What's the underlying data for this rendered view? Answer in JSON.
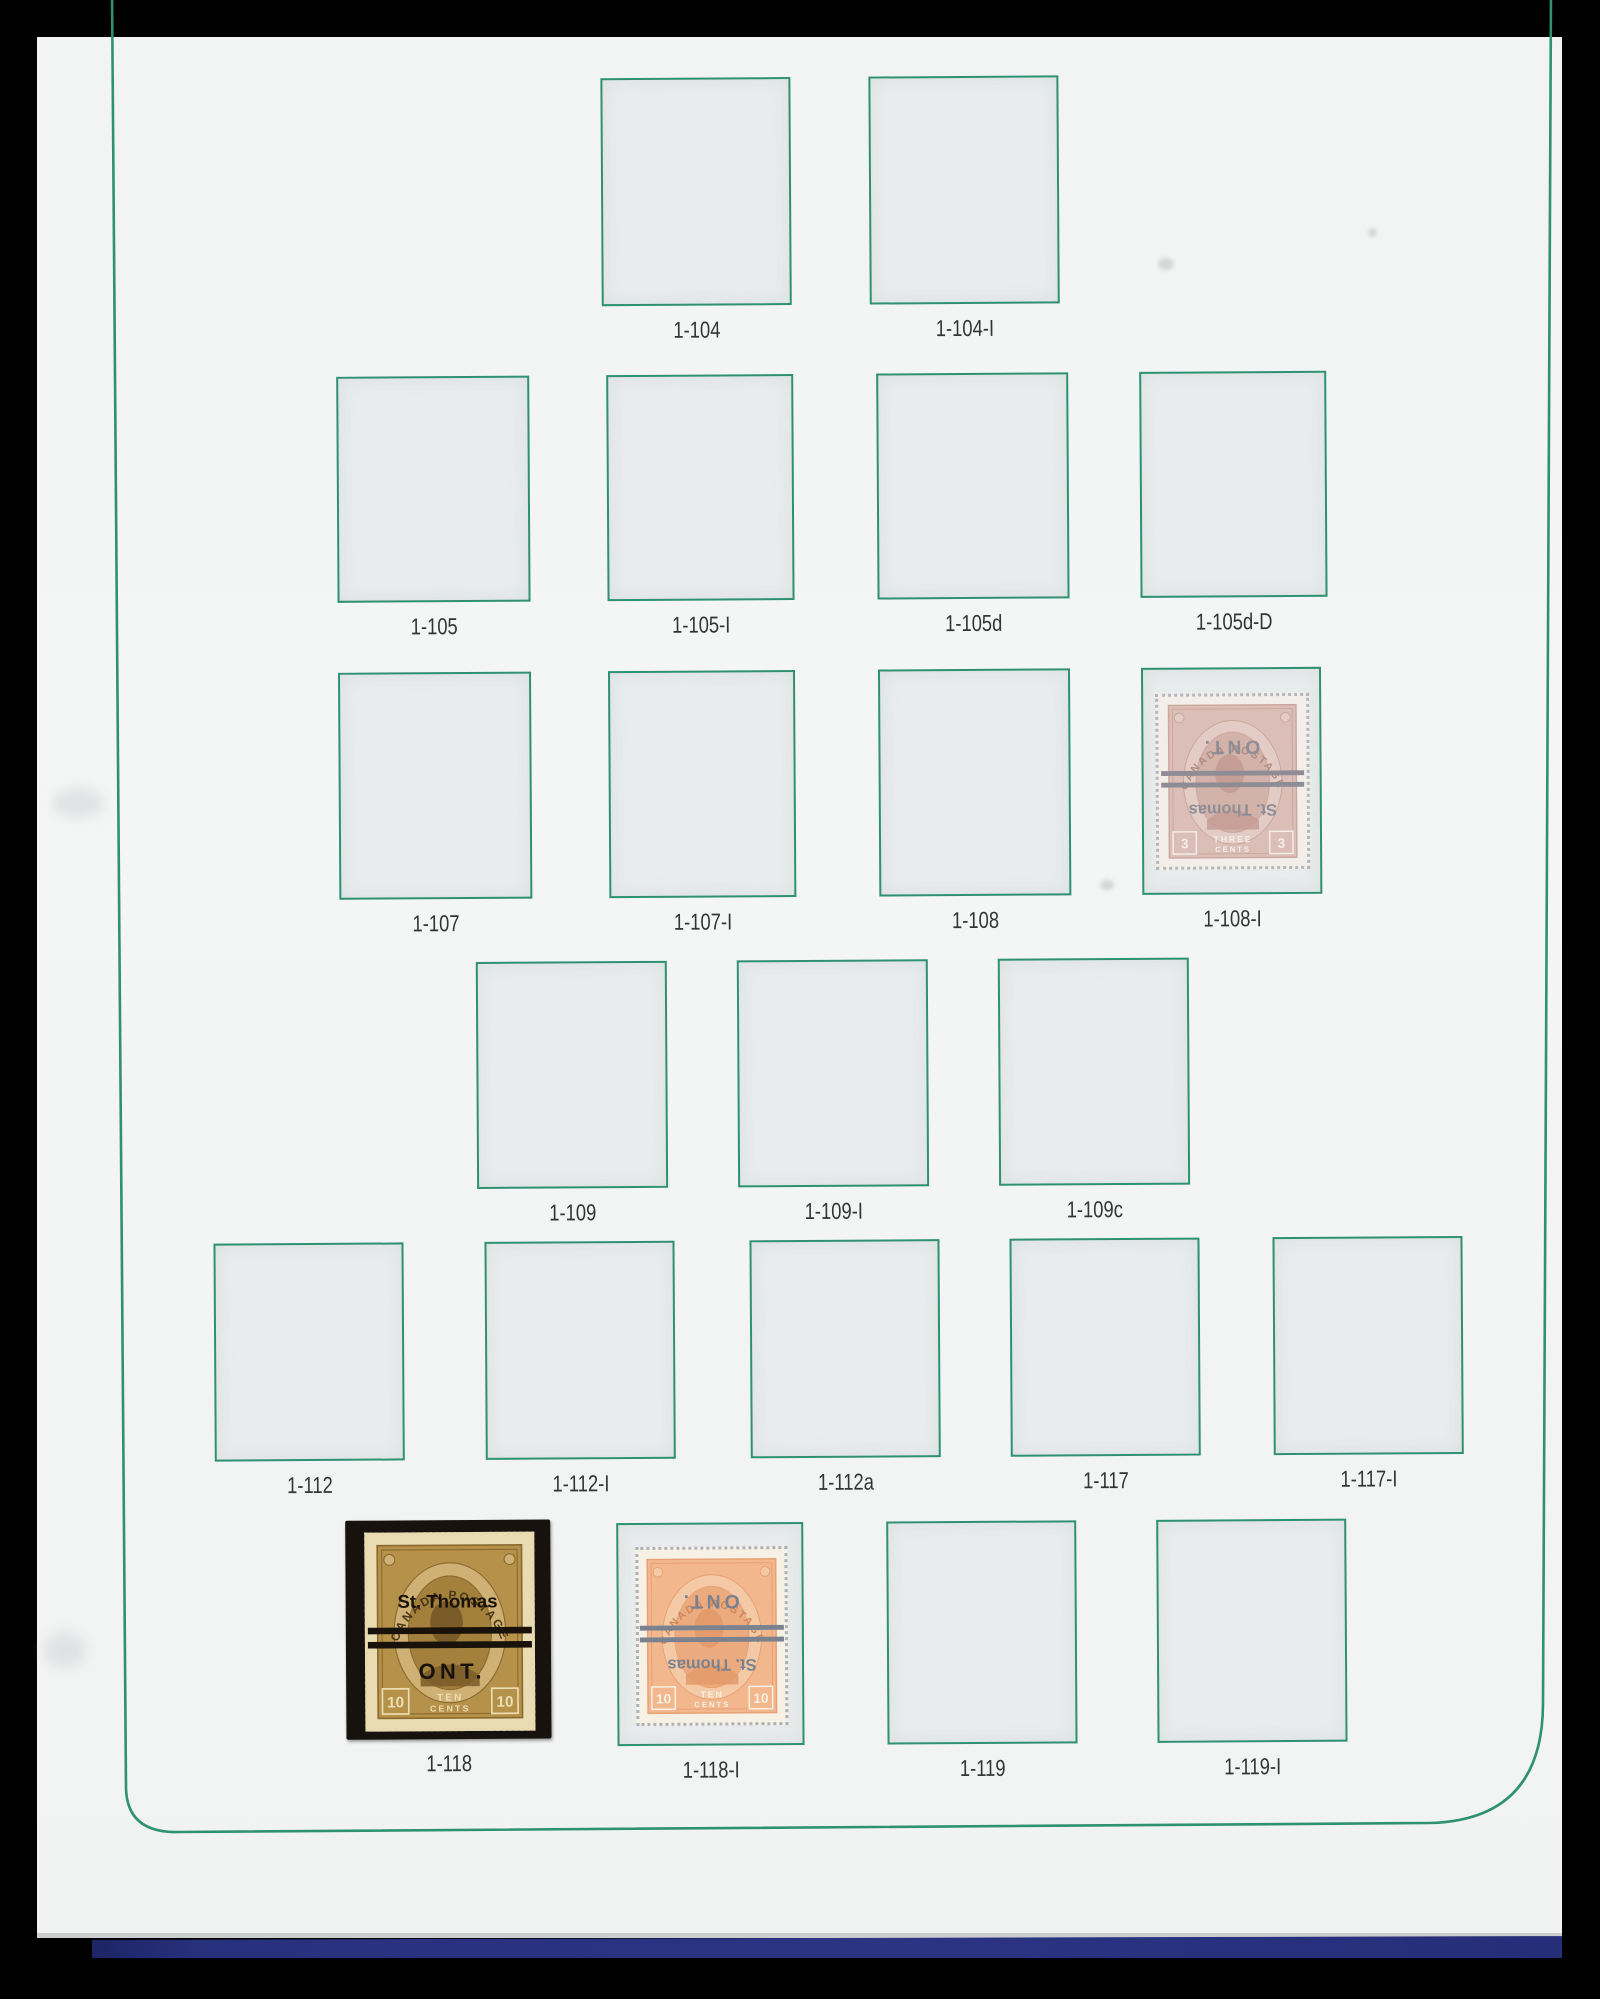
{
  "page": {
    "background": "#f3f4f5",
    "frame_green": "#2e9170",
    "box_fill": "#e9ecec",
    "label_color": "#343434",
    "binder_navy": "#28317e",
    "binder_black": "#000000"
  },
  "slots": [
    {
      "label": "1-104"
    },
    {
      "label": "1-104-I"
    },
    {
      "label": "1-105"
    },
    {
      "label": "1-105-I"
    },
    {
      "label": "1-105d"
    },
    {
      "label": "1-105d-D"
    },
    {
      "label": "1-107"
    },
    {
      "label": "1-107-I"
    },
    {
      "label": "1-108"
    },
    {
      "label": "1-108-I"
    },
    {
      "label": "1-109"
    },
    {
      "label": "1-109-I"
    },
    {
      "label": "1-109c"
    },
    {
      "label": "1-112"
    },
    {
      "label": "1-112-I"
    },
    {
      "label": "1-112a"
    },
    {
      "label": "1-117"
    },
    {
      "label": "1-117-I"
    },
    {
      "label": "1-118"
    },
    {
      "label": "1-118-I"
    },
    {
      "label": "1-119"
    },
    {
      "label": "1-119-I"
    }
  ],
  "stamps": {
    "mounted_118": {
      "country": "CANADA POSTAGE",
      "value": "10",
      "word1": "TEN",
      "word2": "CENTS",
      "precancel_city": "St. Thomas",
      "precancel_prov": "ONT.",
      "face_color": "#b5914a",
      "mount_color": "#17120d"
    },
    "ghost_118i": {
      "country": "CANADA POSTAGE",
      "value": "10",
      "word1": "TEN",
      "word2": "CENTS",
      "precancel_city": "St. Thomas",
      "precancel_prov": "ONT.",
      "face_color": "#f4ae7d"
    },
    "ghost_108i": {
      "country": "CANADA POSTAGE",
      "value": "3",
      "word1": "THREE",
      "word2": "CENTS",
      "precancel_city": "St. Thomas",
      "precancel_prov": "ONT.",
      "face_color": "#d9b7ae"
    }
  }
}
